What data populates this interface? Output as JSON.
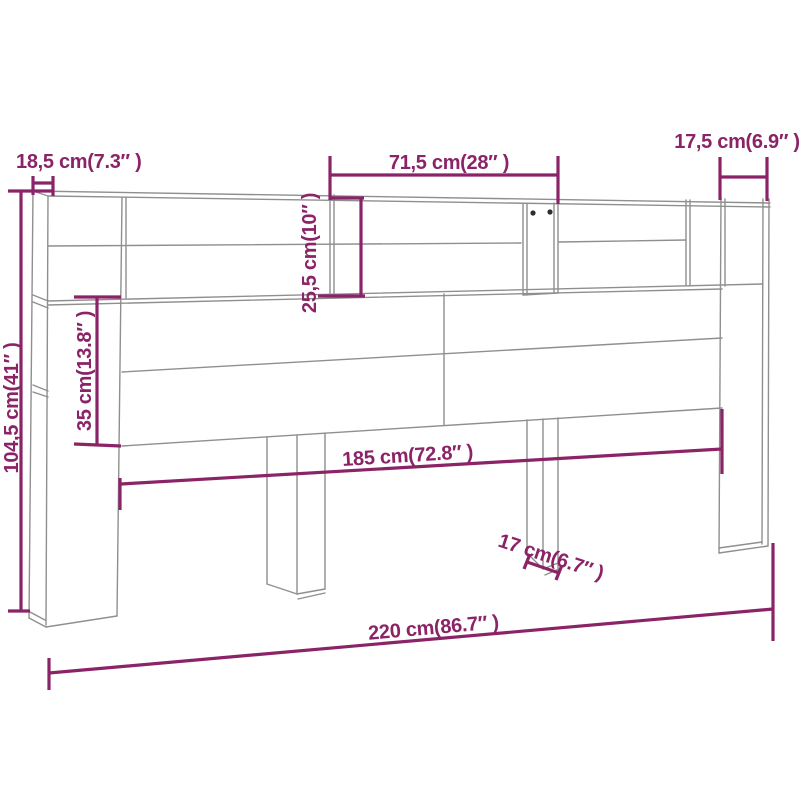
{
  "figure": {
    "kind": "furniture-dimension-diagram",
    "subject": "headboard cabinet line drawing with measurement annotations"
  },
  "colors": {
    "dimension_accent": "#8B2367",
    "outline_gray": "#8f8f8f",
    "knob_dark": "#2e2e2e",
    "background": "#ffffff"
  },
  "dimensions": [
    {
      "id": "side-depth-top-left",
      "label": "18,5 cm(7.3″ )",
      "cm": 18.5,
      "inches": 7.3
    },
    {
      "id": "top-shelf-width",
      "label": "71,5 cm(28″ )",
      "cm": 71.5,
      "inches": 28
    },
    {
      "id": "top-right-compartment",
      "label": "17,5 cm(6.9″ )",
      "cm": 17.5,
      "inches": 6.9
    },
    {
      "id": "overall-height",
      "label": "104,5 cm(41″ )",
      "cm": 104.5,
      "inches": 41
    },
    {
      "id": "front-panel-height",
      "label": "35 cm(13.8″ )",
      "cm": 35,
      "inches": 13.8
    },
    {
      "id": "shelf-compartment-height",
      "label": "25,5 cm(10″ )",
      "cm": 25.5,
      "inches": 10
    },
    {
      "id": "inner-width",
      "label": "185 cm(72.8″ )",
      "cm": 185,
      "inches": 72.8
    },
    {
      "id": "leg-width",
      "label": "17 cm(6.7″ )",
      "cm": 17,
      "inches": 6.7
    },
    {
      "id": "overall-width",
      "label": "220 cm(86.7″ )",
      "cm": 220,
      "inches": 86.7
    }
  ]
}
